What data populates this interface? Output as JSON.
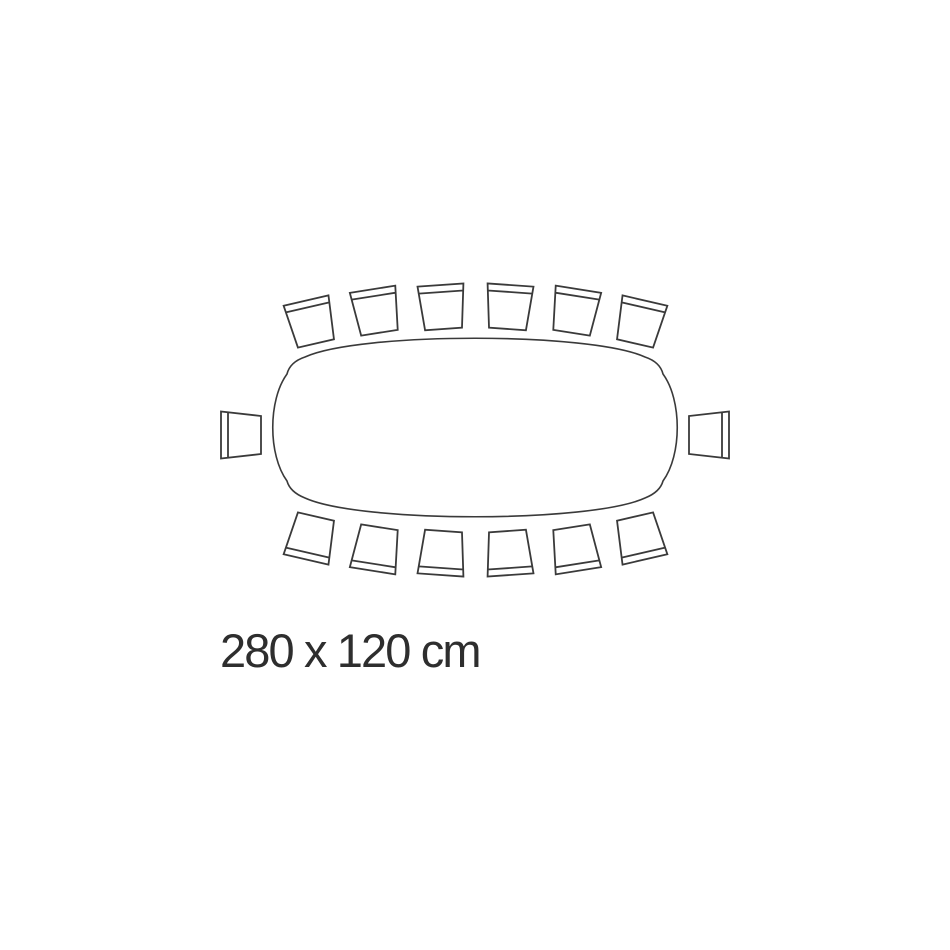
{
  "diagram": {
    "label": "280 x 120 cm",
    "stroke_color": "#3a3a3a",
    "text_color": "#2e2e2e",
    "background_color": "#ffffff",
    "table": {
      "shape": "boat-shaped-rectangle",
      "width_cm": 280,
      "depth_cm": 120,
      "path": "M 305 357 C 360 332 590 332 645 357 Q 660 362 663 374 C 682 400 682 455 663 481 Q 660 492 645 498 C 590 523 360 523 305 498 Q 290 492 287 481 C 268 455 268 400 287 374 Q 290 362 305 357 Z",
      "stroke_width": 1.6
    },
    "chairs": {
      "count": 14,
      "stroke_width": 1.8,
      "types": {
        "standard": {
          "back_width": 46,
          "front_width": 37,
          "depth": 44,
          "band_inset": 7
        },
        "end": {
          "back_width": 47,
          "front_width": 38,
          "depth": 40,
          "band_inset": 7
        }
      },
      "items": [
        {
          "position": "top-1",
          "type": "standard",
          "x": 311,
          "y": 322,
          "rot": -13
        },
        {
          "position": "top-2",
          "type": "standard",
          "x": 376,
          "y": 311,
          "rot": -9
        },
        {
          "position": "top-3",
          "type": "standard",
          "x": 442,
          "y": 307,
          "rot": -4
        },
        {
          "position": "top-4",
          "type": "standard",
          "x": 509,
          "y": 307,
          "rot": 4
        },
        {
          "position": "top-5",
          "type": "standard",
          "x": 575,
          "y": 311,
          "rot": 9
        },
        {
          "position": "top-6",
          "type": "standard",
          "x": 640,
          "y": 322,
          "rot": 13
        },
        {
          "position": "right",
          "type": "end",
          "x": 709,
          "y": 435,
          "rot": 90
        },
        {
          "position": "bottom-6",
          "type": "standard",
          "x": 640,
          "y": 538,
          "rot": 167
        },
        {
          "position": "bottom-5",
          "type": "standard",
          "x": 575,
          "y": 549,
          "rot": 171
        },
        {
          "position": "bottom-4",
          "type": "standard",
          "x": 509,
          "y": 553,
          "rot": 176
        },
        {
          "position": "bottom-3",
          "type": "standard",
          "x": 442,
          "y": 553,
          "rot": 184
        },
        {
          "position": "bottom-2",
          "type": "standard",
          "x": 376,
          "y": 549,
          "rot": 189
        },
        {
          "position": "bottom-1",
          "type": "standard",
          "x": 311,
          "y": 538,
          "rot": 193
        },
        {
          "position": "left",
          "type": "end",
          "x": 241,
          "y": 435,
          "rot": -90
        }
      ]
    },
    "label_layout": {
      "x": 220,
      "y": 667,
      "text_length": 262
    }
  }
}
